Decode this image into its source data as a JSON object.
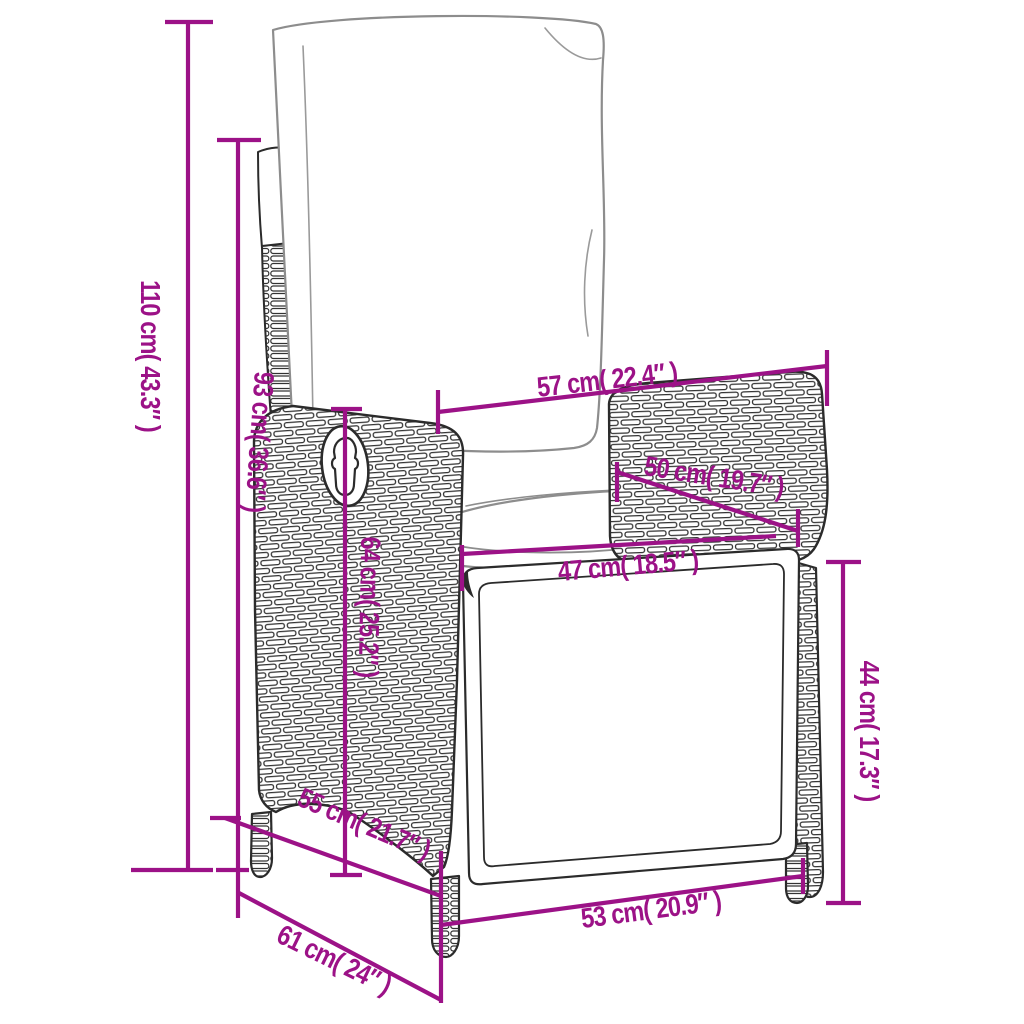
{
  "figure": {
    "name": "reclining-rattan-garden-chair-dimension-diagram",
    "style": "black line-art sketch on white with magenta dimension lines",
    "background_color": "#ffffff",
    "accent_color": "#9c1287",
    "outline_color": "#2b2b2b",
    "cushion_outline_color": "#8d8d8d"
  },
  "dimensions": [
    {
      "id": "overall-height",
      "label": "110 cm( 43.3″ )",
      "cm": 110,
      "inch": 43.3,
      "orientation": "vertical"
    },
    {
      "id": "backrest-height",
      "label": "93 cm( 36.6″ )",
      "cm": 93,
      "inch": 36.6,
      "orientation": "vertical"
    },
    {
      "id": "top-width",
      "label": "57 cm( 22.4″ )",
      "cm": 57,
      "inch": 22.4,
      "orientation": "horizontal"
    },
    {
      "id": "armrest-length",
      "label": "50 cm( 19.7″ )",
      "cm": 50,
      "inch": 19.7,
      "orientation": "diagonal"
    },
    {
      "id": "seat-width",
      "label": "47 cm( 18.5″ )",
      "cm": 47,
      "inch": 18.5,
      "orientation": "horizontal"
    },
    {
      "id": "armrest-height",
      "label": "64 cm( 25.2″ )",
      "cm": 64,
      "inch": 25.2,
      "orientation": "vertical"
    },
    {
      "id": "seat-depth",
      "label": "55 cm( 21.7″ )",
      "cm": 55,
      "inch": 21.7,
      "orientation": "diagonal"
    },
    {
      "id": "seat-height",
      "label": "44 cm( 17.3″ )",
      "cm": 44,
      "inch": 17.3,
      "orientation": "vertical"
    },
    {
      "id": "front-width",
      "label": "53 cm( 20.9″ )",
      "cm": 53,
      "inch": 20.9,
      "orientation": "horizontal"
    },
    {
      "id": "overall-depth",
      "label": "61 cm( 24″ )",
      "cm": 61,
      "inch": 24,
      "orientation": "diagonal"
    }
  ]
}
